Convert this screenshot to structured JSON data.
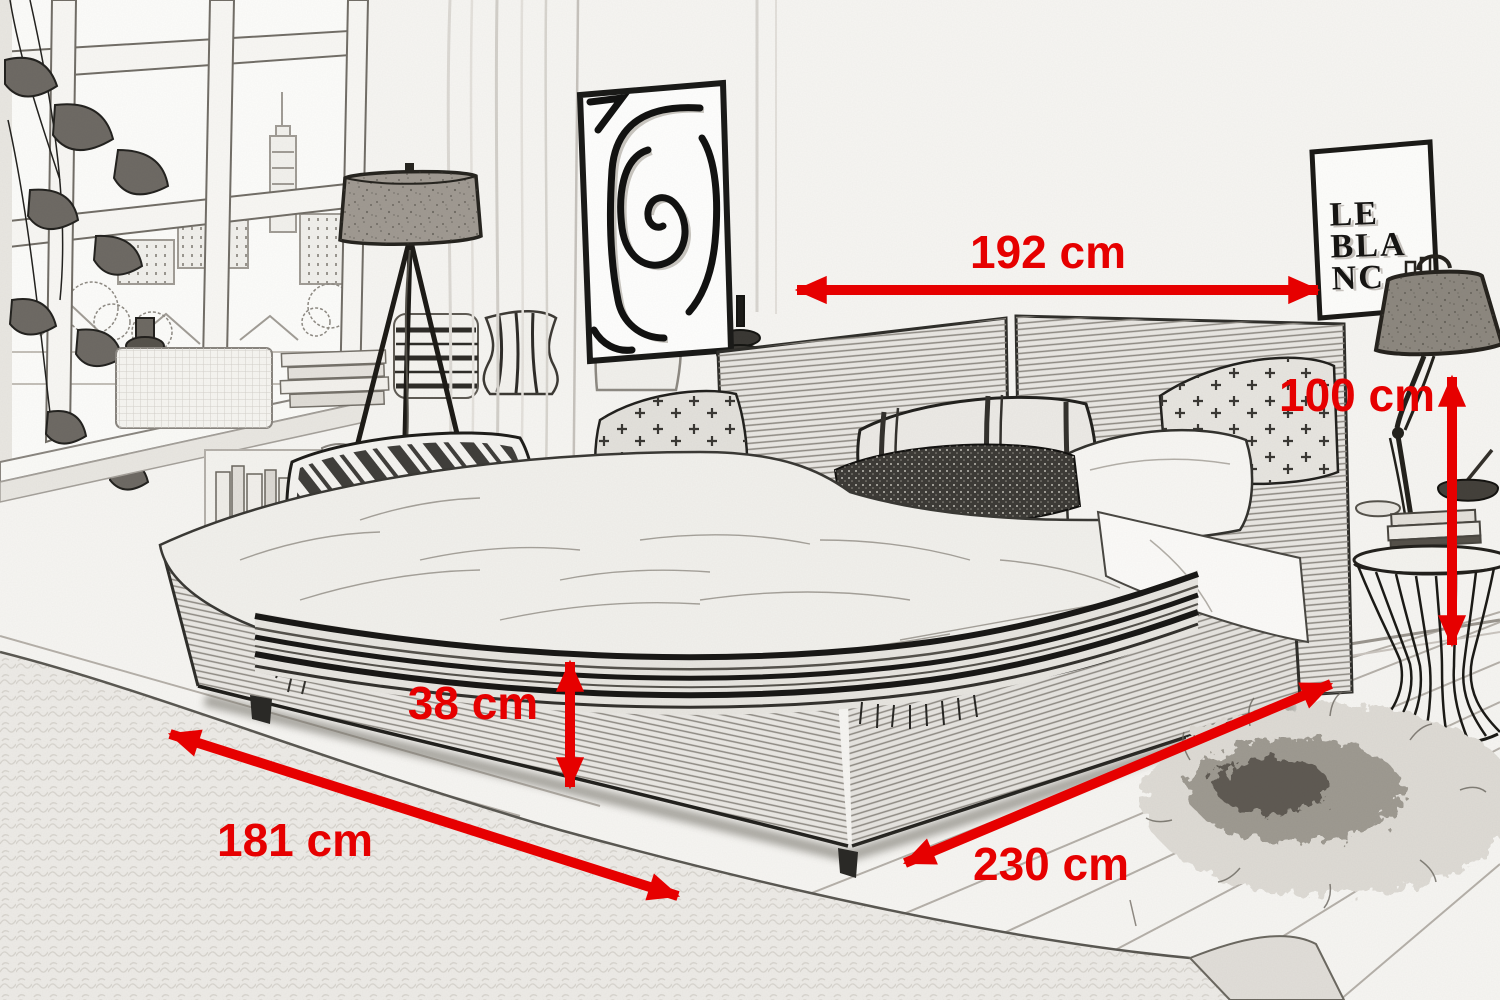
{
  "scene": {
    "poster_lines": [
      "LE",
      "BLA",
      "NC"
    ]
  },
  "annotation": {
    "color": "#e60000",
    "dimensions": [
      {
        "name": "bed-width",
        "label": "192 cm"
      },
      {
        "name": "headboard-height",
        "label": "100 cm"
      },
      {
        "name": "frame-height",
        "label": "38 cm"
      },
      {
        "name": "bed-depth",
        "label": "181 cm"
      },
      {
        "name": "bed-length",
        "label": "230 cm"
      }
    ]
  }
}
